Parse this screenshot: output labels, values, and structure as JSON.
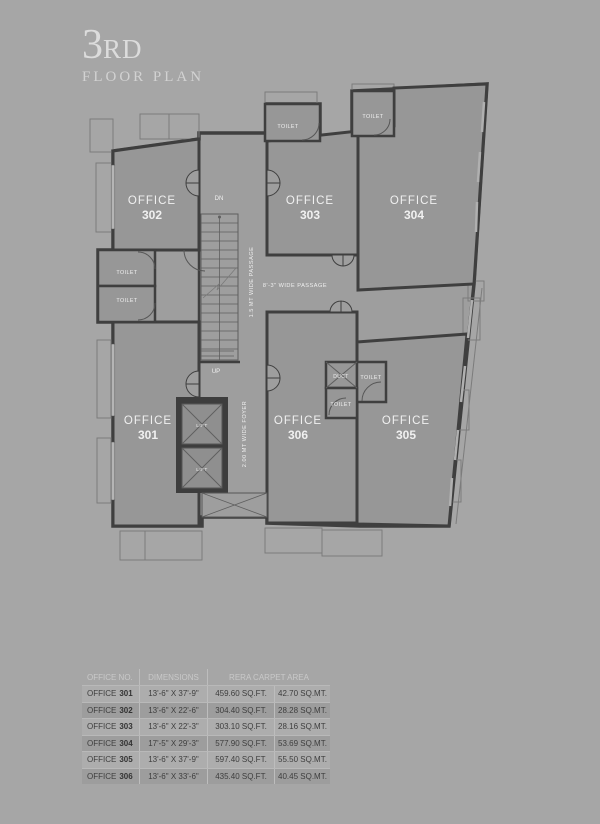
{
  "title": {
    "number": "3",
    "ordinal": "RD",
    "subtitle": "FLOOR PLAN"
  },
  "colors": {
    "background": "#a6a6a6",
    "walls": "#3f3f3f",
    "office_floor": "#979797",
    "passage_floor": "#9e9e9e",
    "plan_text": "#f0f0f0"
  },
  "plan": {
    "offices": [
      {
        "label": "OFFICE",
        "number": "301"
      },
      {
        "label": "OFFICE",
        "number": "302"
      },
      {
        "label": "OFFICE",
        "number": "303"
      },
      {
        "label": "OFFICE",
        "number": "304"
      },
      {
        "label": "OFFICE",
        "number": "305"
      },
      {
        "label": "OFFICE",
        "number": "306"
      }
    ],
    "room_labels": {
      "toilet": "TOILET",
      "duct": "DUCT",
      "lift": "LIFT"
    },
    "annotations": {
      "dn": "DN",
      "up": "UP",
      "passage_vertical": "1.5 MT WIDE PASSAGE",
      "passage_horizontal": "8'-3\" WIDE PASSAGE",
      "foyer": "2.00 MT WIDE FOYER"
    }
  },
  "table": {
    "columns": [
      "OFFICE NO.",
      "DIMENSIONS",
      "RERA CARPET AREA"
    ],
    "office_word": "OFFICE",
    "rows": [
      {
        "no": "301",
        "dim": "13'-6\" X 37'-9\"",
        "sqft": "459.60 SQ.FT.",
        "sqmt": "42.70 SQ.MT."
      },
      {
        "no": "302",
        "dim": "13'-6\" X 22'-6\"",
        "sqft": "304.40 SQ.FT.",
        "sqmt": "28.28 SQ.MT."
      },
      {
        "no": "303",
        "dim": "13'-6\" X 22'-3\"",
        "sqft": "303.10 SQ.FT.",
        "sqmt": "28.16 SQ.MT."
      },
      {
        "no": "304",
        "dim": "17'-5\" X 29'-3\"",
        "sqft": "577.90 SQ.FT.",
        "sqmt": "53.69 SQ.MT."
      },
      {
        "no": "305",
        "dim": "13'-6\" X 37'-9\"",
        "sqft": "597.40 SQ.FT.",
        "sqmt": "55.50 SQ.MT."
      },
      {
        "no": "306",
        "dim": "13'-6\" X 33'-6\"",
        "sqft": "435.40 SQ.FT.",
        "sqmt": "40.45 SQ.MT."
      }
    ]
  }
}
